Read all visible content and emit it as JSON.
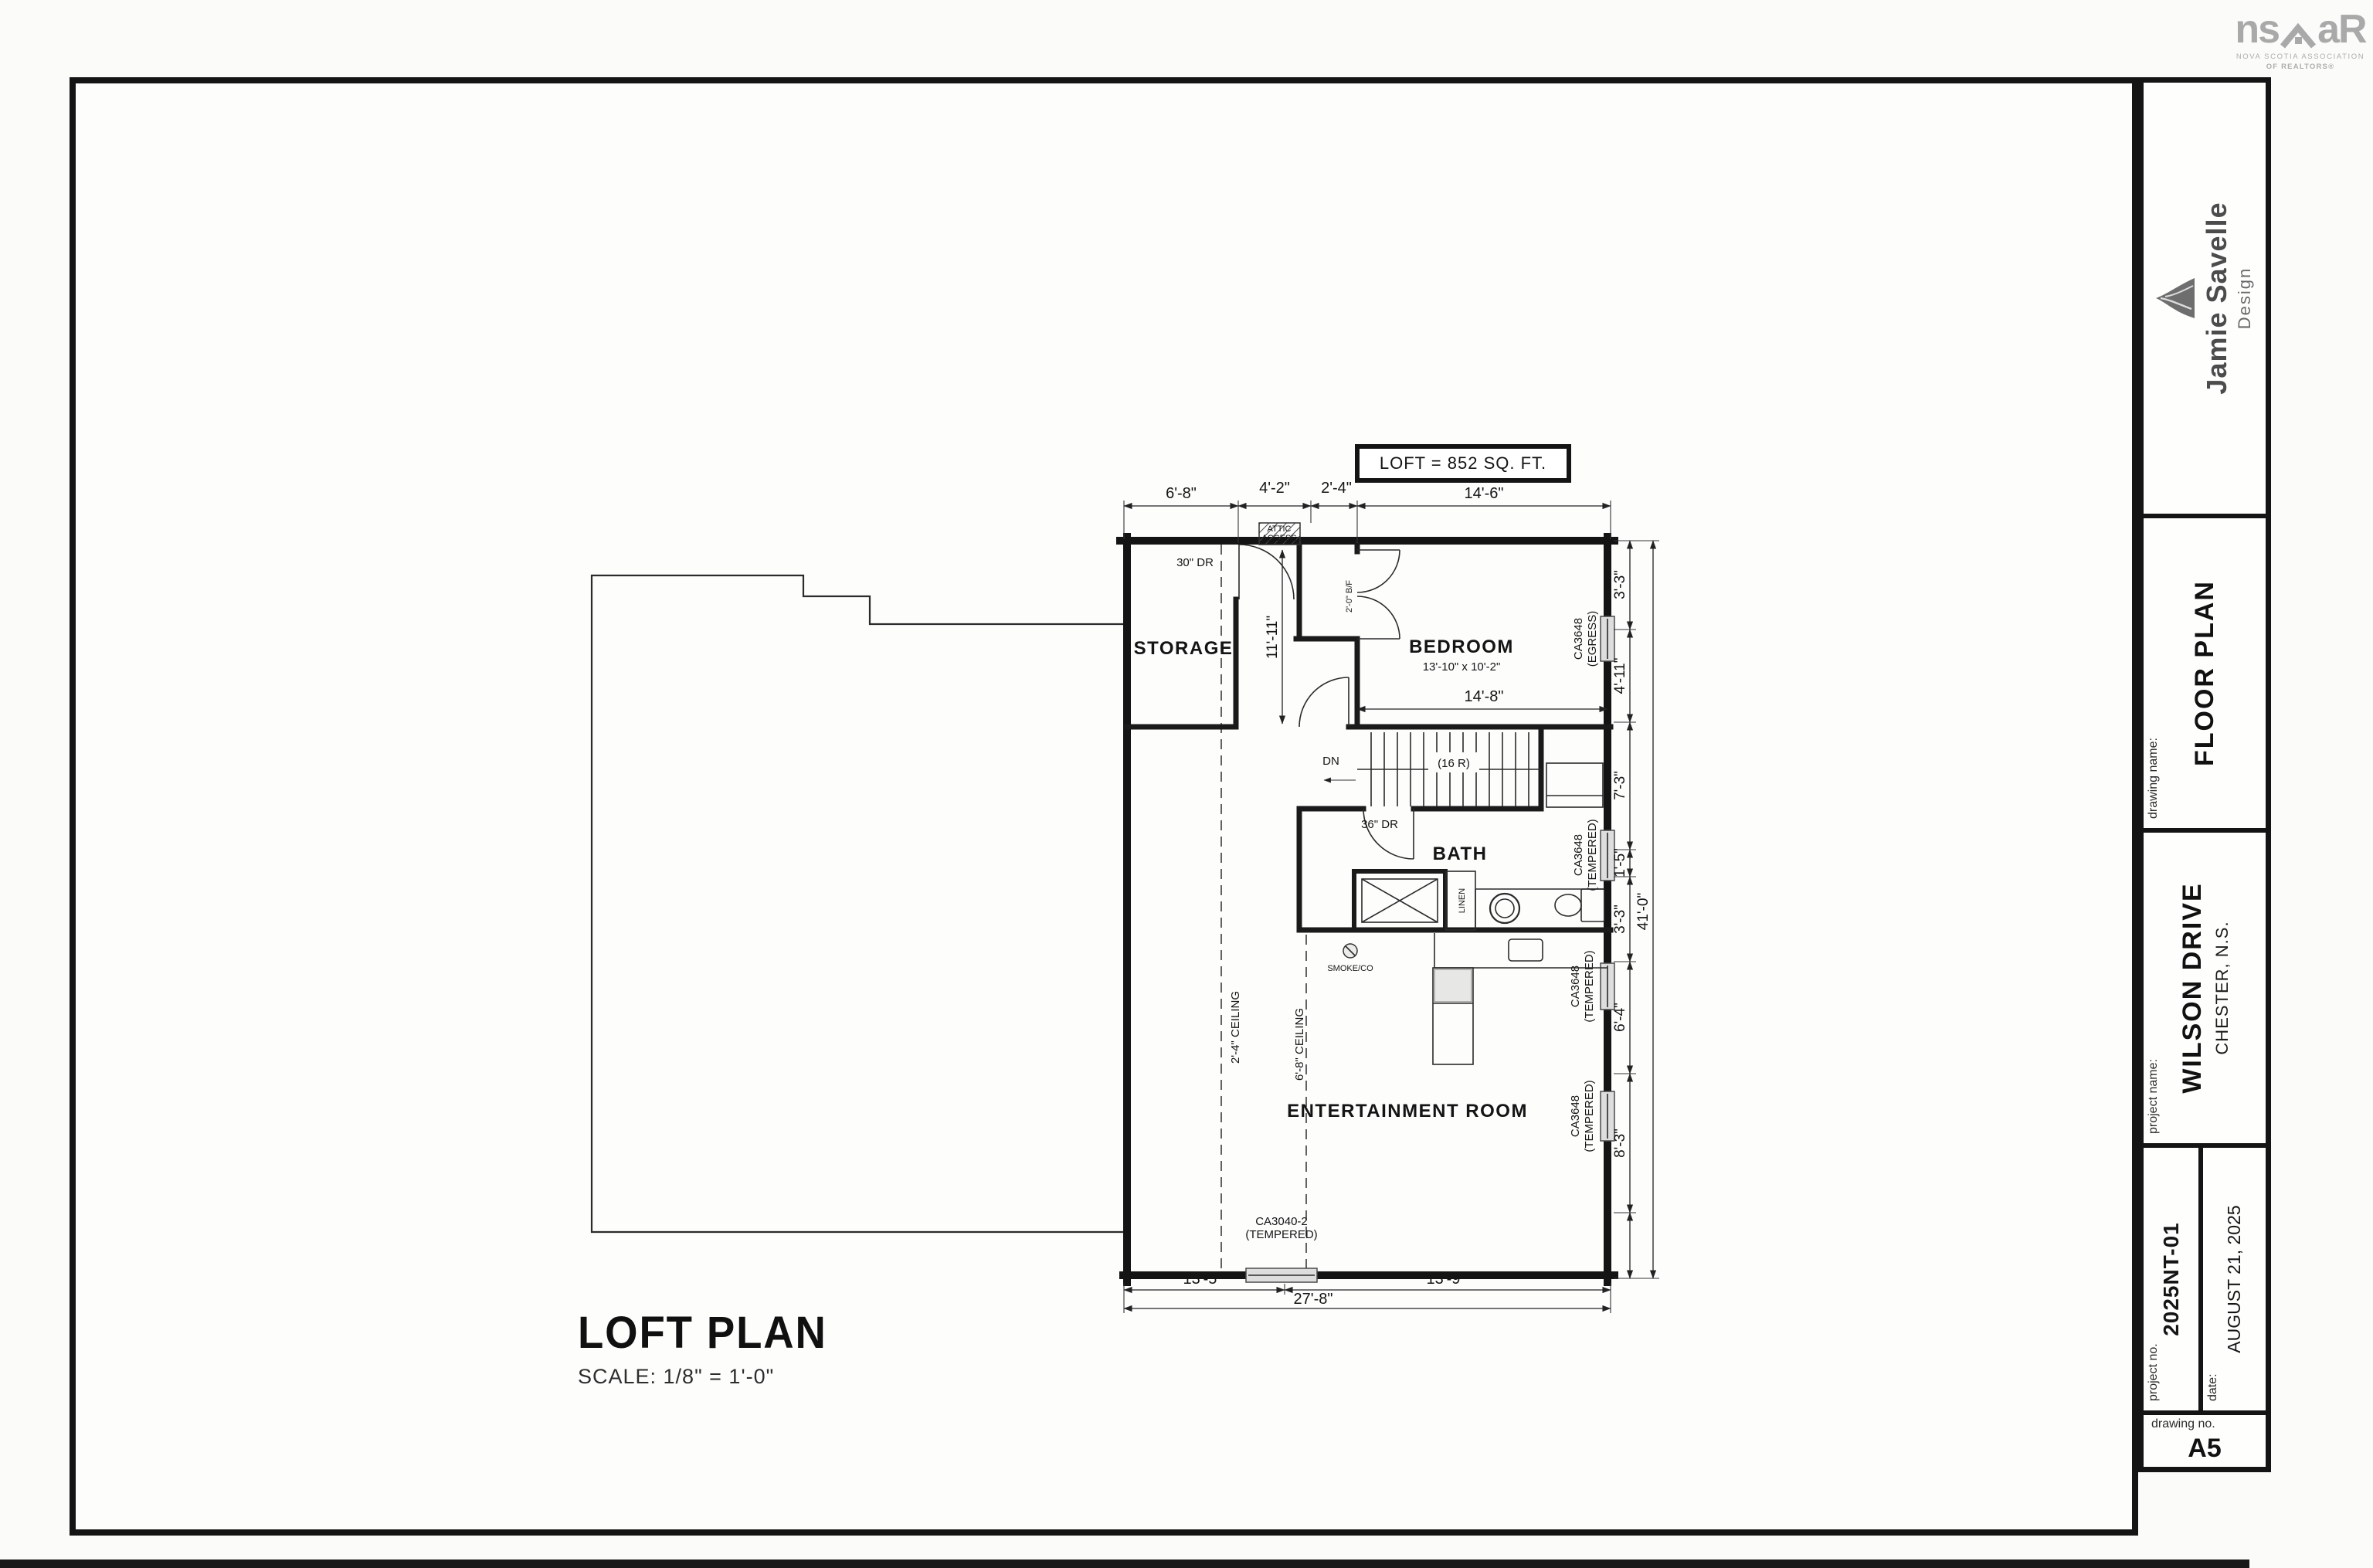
{
  "nsar_logo": {
    "big_left": "ns",
    "big_right": "aR",
    "tag_line1": "NOVA SCOTIA ASSOCIATION",
    "tag_line2": "OF REALTORS®"
  },
  "title_block": {
    "company": {
      "name": "Jamie Savelle",
      "sub": "Design"
    },
    "drawing_name": {
      "label": "drawing name:",
      "value": "FLOOR PLAN"
    },
    "project_name": {
      "label": "project name:",
      "value": "WILSON DRIVE",
      "sub": "CHESTER, N.S."
    },
    "project_no": {
      "label": "project no.",
      "value": "2025NT-01"
    },
    "date": {
      "label": "date:",
      "value": "AUGUST 21, 2025"
    },
    "drawing_no": {
      "label": "drawing no.",
      "value": "A5"
    }
  },
  "plan_title": {
    "title": "LOFT PLAN",
    "scale": "SCALE: 1/8\" = 1'-0\""
  },
  "plan": {
    "area_box": "LOFT = 852 SQ. FT.",
    "rooms": {
      "storage": "STORAGE",
      "bedroom": "BEDROOM",
      "bedroom_size": "13'-10\" x 10'-2\"",
      "bath": "BATH",
      "entertainment": "ENTERTAINMENT ROOM",
      "linen": "LINEN"
    },
    "stairs": {
      "dn": "DN",
      "risers": "(16 R)"
    },
    "doors": {
      "storage": "30\" DR",
      "bath": "36\" DR",
      "closet": "2'-0\" B/F"
    },
    "attic": {
      "line1": "ATTIC",
      "line2": "ACCESS"
    },
    "smoke": "SMOKE/CO",
    "ceilings": {
      "left": "2'-4\" CEILING",
      "right": "6'-8\" CEILING"
    },
    "windows": {
      "bedroom1": "CA3648",
      "bedroom2": "(EGRESS)",
      "bath1": "CA3648",
      "bath2": "(TEMPERED)",
      "ent1a": "CA3648",
      "ent1b": "(TEMPERED)",
      "ent2a": "CA3648",
      "ent2b": "(TEMPERED)",
      "bottom1": "CA3040-2",
      "bottom2": "(TEMPERED)"
    },
    "dims": {
      "top": [
        "6'-8\"",
        "4'-2\"",
        "2'-4\"",
        "14'-6\""
      ],
      "right": [
        "3'-3\"",
        "4'-11\"",
        "7'-3\"",
        "1'-5\"",
        "3'-3\"",
        "6'-4\"",
        "8'-3\""
      ],
      "right_total": "41'-0\"",
      "bottom": [
        "13'-5\"",
        "13'-9\""
      ],
      "bottom_total": "27'-8\"",
      "bedroom_width": "14'-8\"",
      "hall": "11'-11\""
    }
  }
}
